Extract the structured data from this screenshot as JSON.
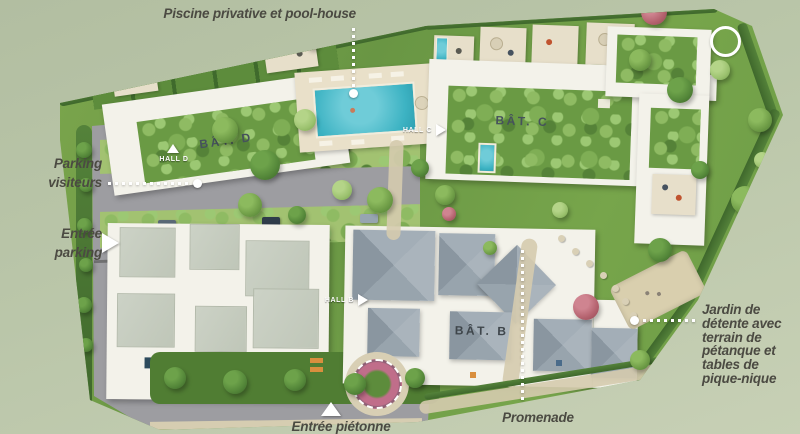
{
  "labels": {
    "pool": "Piscine privative et pool-house",
    "parking_visitors_line1": "Parking",
    "parking_visitors_line2": "visiteurs",
    "entrance_parking_line1": "Entrée",
    "entrance_parking_line2": "parking",
    "pedestrian_entrance": "Entrée piétonne",
    "promenade": "Promenade",
    "garden_lines": [
      "Jardin de",
      "détente avec",
      "terrain de",
      "pétanque et",
      "tables de",
      "pique-nique"
    ]
  },
  "buildings": {
    "bat_d": "BÂT. D",
    "bat_c": "BÂT. C",
    "bat_b": "BÂT. B"
  },
  "halls": {
    "hall_d": "HALL D",
    "hall_c": "HALL C",
    "hall_b": "HALL B"
  },
  "colors": {
    "background": "#bac6a9",
    "label_text": "#4b4a42",
    "road": "#9d9da1",
    "sidewalk": "#d6cdb1",
    "pool_water": "#3db3c3",
    "deck": "#e9e0c9",
    "building_white": "#f3f2ea",
    "flat_roof_panel": "#c9cfc2",
    "pitched_roof": "#a3aeb6",
    "green_roof": "#6a9a44",
    "lawn": "#71a047",
    "hedge": "#47702f",
    "petanque_sand": "#d9cfae",
    "flower_pink": "#c06e8a",
    "marker": "#ffffff"
  }
}
